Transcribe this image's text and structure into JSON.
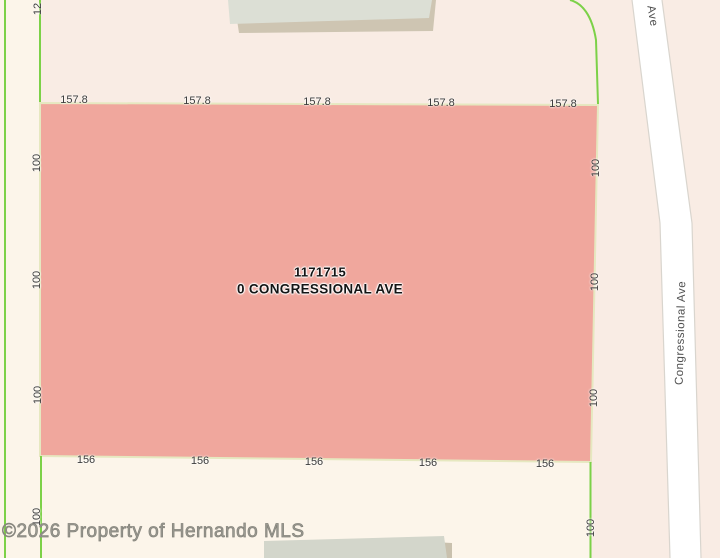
{
  "parcel": {
    "id": "1171715",
    "address": "0 CONGRESSIONAL AVE",
    "top_dimensions": [
      "157.8",
      "157.8",
      "157.8",
      "157.8",
      "157.8"
    ],
    "bottom_dimensions": [
      "156",
      "156",
      "156",
      "156",
      "156"
    ],
    "left_dimensions": [
      "100",
      "100",
      "100",
      "100"
    ],
    "right_dimensions": [
      "100",
      "100",
      "100",
      "100"
    ],
    "adjacent_lot_dimension": "12"
  },
  "roads": {
    "right_road_name": "Congressional Ave",
    "top_road_name_partial": "Ave"
  },
  "watermark": "©2026 Property of Hernando MLS",
  "colors": {
    "background": "#f9ece4",
    "adjacent_area": "#fcf5ea",
    "parcel_fill": "#f0a79d",
    "parcel_border": "#e6e8c0",
    "lot_boundary_green": "#7cd148",
    "road_fill": "#ffffff",
    "road_edge": "#d9d5ce",
    "building_fill": "#dcdfd5",
    "building_shadow": "#cec5b2",
    "dimension_text": "#3c3c3c",
    "watermark_text": "#9b9a92"
  }
}
